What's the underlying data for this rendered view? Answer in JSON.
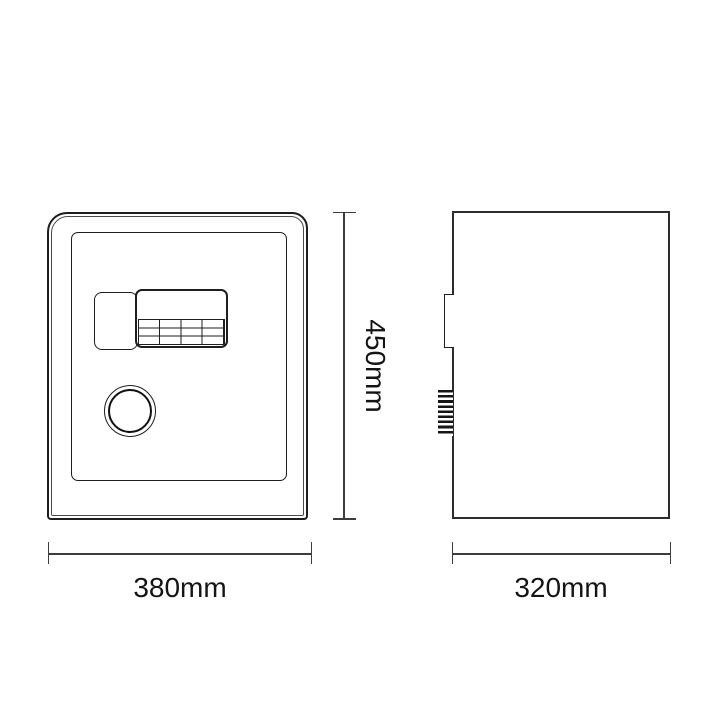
{
  "diagram": {
    "dimensions": {
      "height": {
        "label": "450mm"
      },
      "width": {
        "label": "380mm"
      },
      "depth": {
        "label": "320mm"
      }
    },
    "icons": {
      "knob": "round-dial-knob",
      "knurl": "knurled-knob-side-profile",
      "keypad": "digital-keypad"
    },
    "colors": {
      "background": "#ffffff",
      "outline": "#1e1e1e",
      "dimension_line": "#3d3d3d",
      "label_text": "#141414"
    }
  }
}
